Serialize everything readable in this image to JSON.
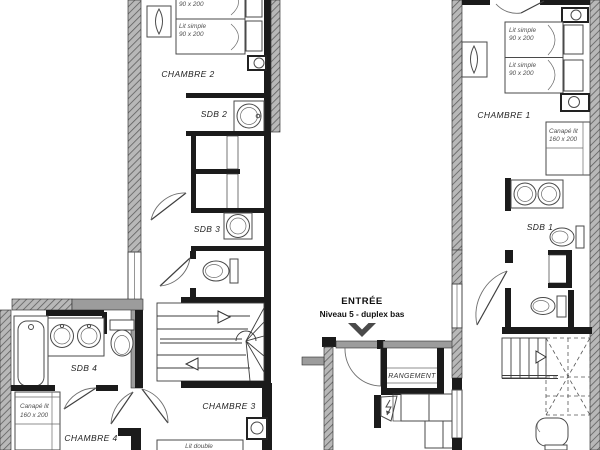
{
  "plan": {
    "entry": {
      "title": "ENTRÉE",
      "subtitle": "Niveau 5 - duplex bas"
    },
    "rooms": {
      "chambre1": "CHAMBRE 1",
      "chambre2": "CHAMBRE 2",
      "chambre3": "CHAMBRE 3",
      "chambre4": "CHAMBRE 4",
      "sdb1": "SDB 1",
      "sdb2": "SDB 2",
      "sdb3": "SDB 3",
      "sdb4": "SDB 4",
      "rangement": "RANGEMENT"
    },
    "furniture": {
      "lit_simple": "Lit simple",
      "lit_simple_size": "90 x 200",
      "lit_double": "Lit double",
      "canape_lit": "Canapé lit",
      "canape_lit_size": "160 x 200"
    },
    "colors": {
      "wall": "#1b1b1b",
      "insulated_wall_fill": "#b8b8b8",
      "insulated_wall_hatch": "#5e5e5e",
      "secondary_wall": "#9c9c9c",
      "fixture_line": "#4a4a4a",
      "label": "#1f1f1f"
    }
  }
}
